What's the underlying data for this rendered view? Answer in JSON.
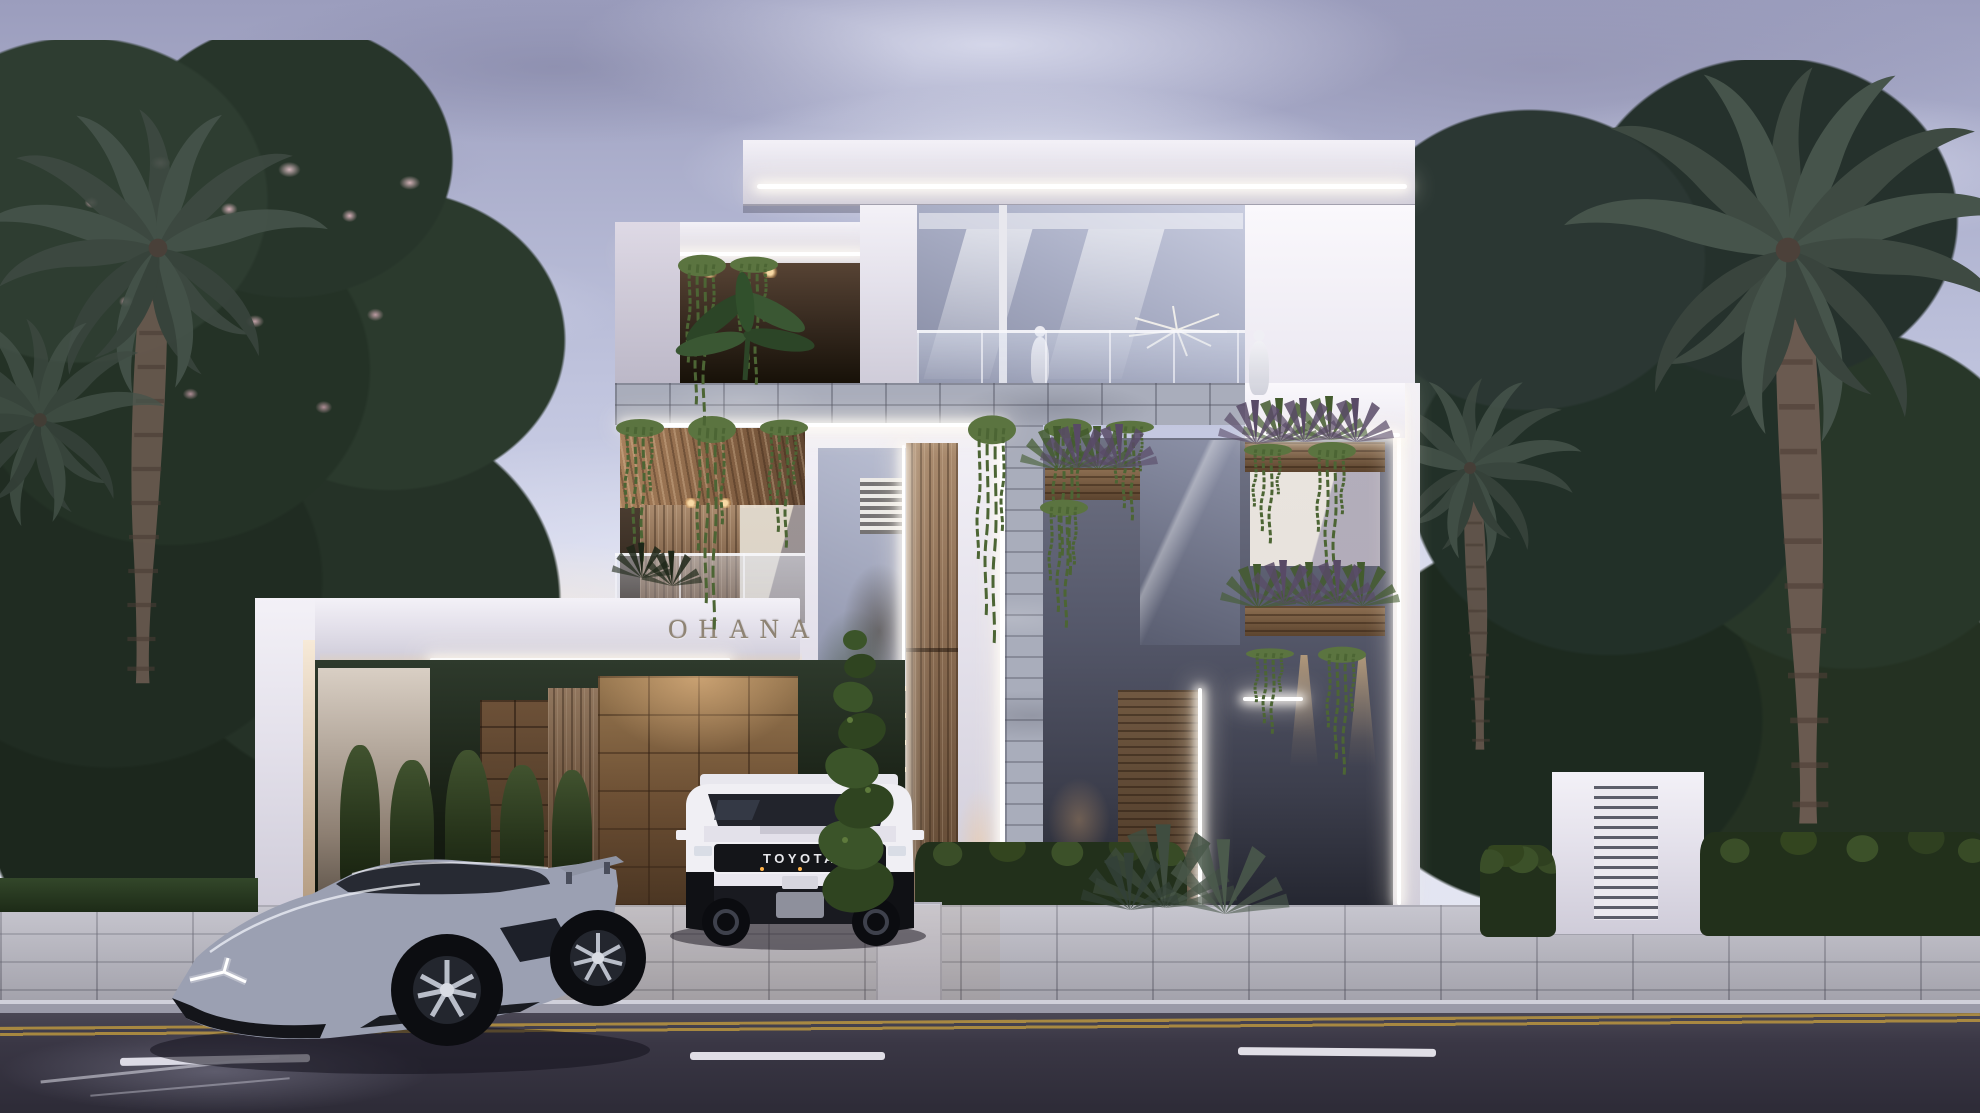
{
  "building": {
    "sign_text": "OHANA",
    "colors": {
      "wall": "#ece9f2",
      "stone_band": "#a9adbb",
      "travertine": "#8a6a4b",
      "wood": "#8a7058",
      "led": "#ffffff"
    }
  },
  "vehicles": {
    "suv": {
      "grille_text": "TOYOTA",
      "body_color": "#f0eff4"
    },
    "supercar": {
      "body_color": "#9ba0b2"
    }
  },
  "environment": {
    "sky_top": "#9b9dbd",
    "sky_horizon": "#e6e8f4",
    "foliage": "#2c3a2e",
    "blossom": "#e7bcc6",
    "paver": "#b9b8c3",
    "road": "#37343f",
    "lane_dash": "#e9e8ef",
    "center_line": "#b9953f",
    "hedge": "#22301b",
    "uplight": "#ffd682"
  }
}
